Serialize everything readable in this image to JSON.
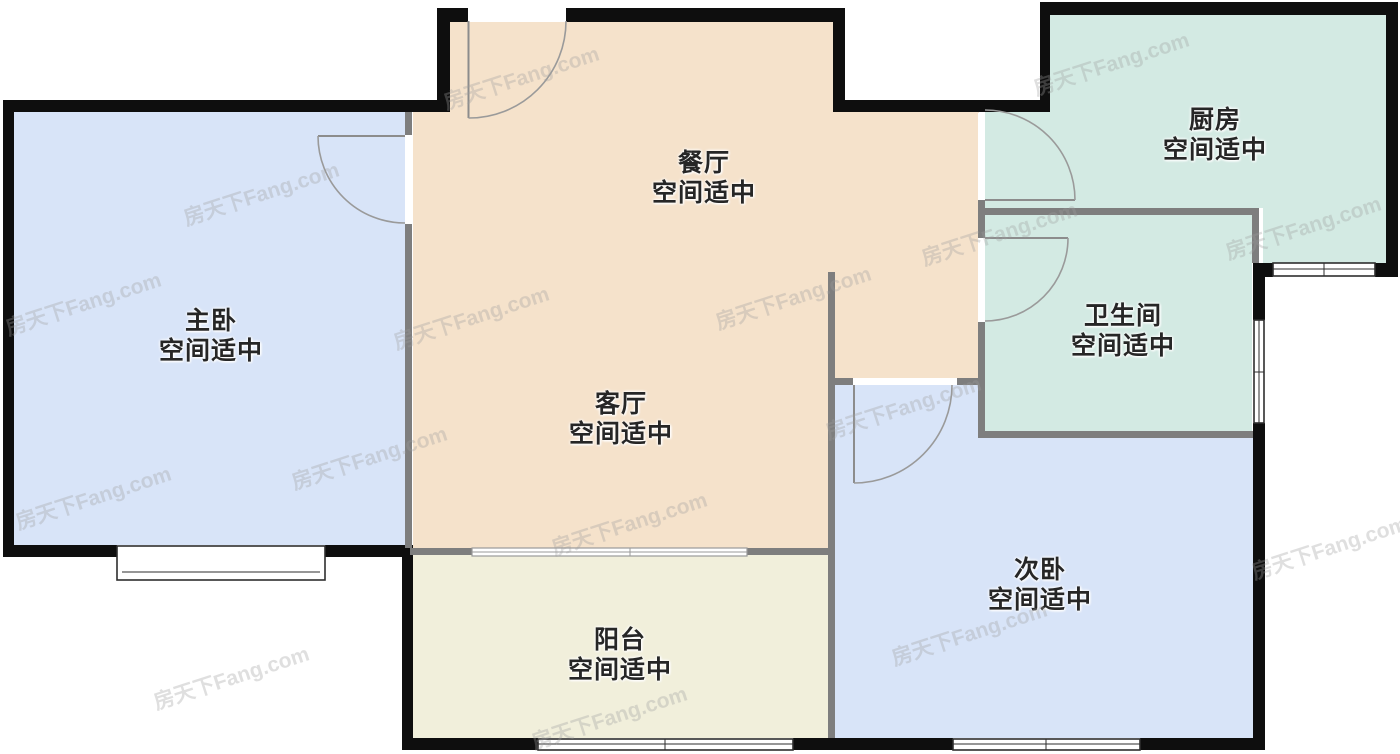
{
  "plan": {
    "title": "户型图",
    "watermark": "房天下Fang.com",
    "wall_color": "#0e0e0e",
    "partition_color": "#7e7e7e",
    "rooms": [
      {
        "id": "master-bedroom",
        "name": "主卧",
        "status": "空间适中",
        "color": "#d8e4f8"
      },
      {
        "id": "dining-room",
        "name": "餐厅",
        "status": "空间适中",
        "color": "#f5e2cb"
      },
      {
        "id": "kitchen",
        "name": "厨房",
        "status": "空间适中",
        "color": "#d3eae3"
      },
      {
        "id": "bathroom",
        "name": "卫生间",
        "status": "空间适中",
        "color": "#d3eae3"
      },
      {
        "id": "living-room",
        "name": "客厅",
        "status": "空间适中",
        "color": "#f5e2cb"
      },
      {
        "id": "second-bedroom",
        "name": "次卧",
        "status": "空间适中",
        "color": "#d8e4f8"
      },
      {
        "id": "balcony",
        "name": "阳台",
        "status": "空间适中",
        "color": "#f1efdb"
      }
    ]
  }
}
